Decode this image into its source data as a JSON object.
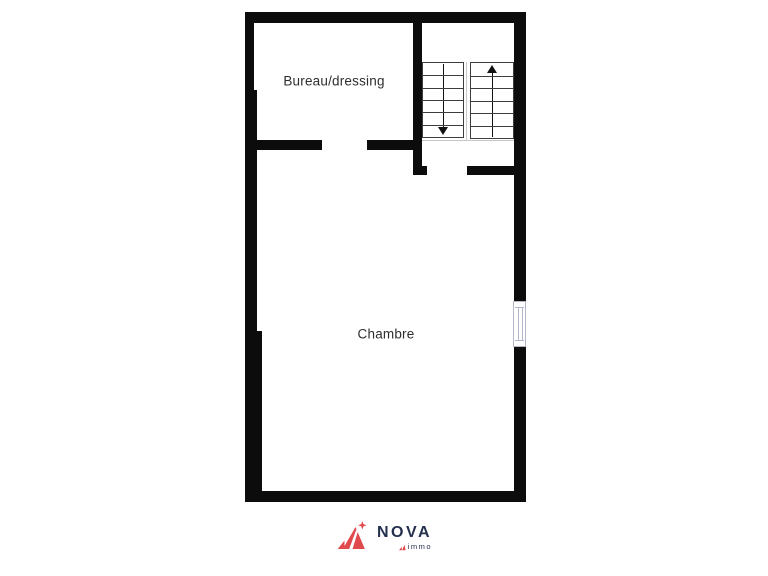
{
  "plan": {
    "rooms": [
      {
        "id": "bureau",
        "label": "Bureau/dressing"
      },
      {
        "id": "chambre",
        "label": "Chambre"
      }
    ],
    "stairs": {
      "treads_per_flight": 6,
      "flights": [
        {
          "side": "left",
          "direction": "down"
        },
        {
          "side": "right",
          "direction": "up"
        }
      ]
    },
    "window": {
      "wall": "right",
      "count": 1
    }
  },
  "brand": {
    "name": "NOVA",
    "sub": "immo"
  },
  "colors": {
    "wall": "#0c0c0c",
    "stair_line": "#3d3d3d",
    "stair_outline": "#c8c8c8",
    "window_frame": "#b6b6ca",
    "label_text": "#2e2e2e",
    "brand_navy": "#24304e",
    "brand_red": "#e04a4d"
  }
}
